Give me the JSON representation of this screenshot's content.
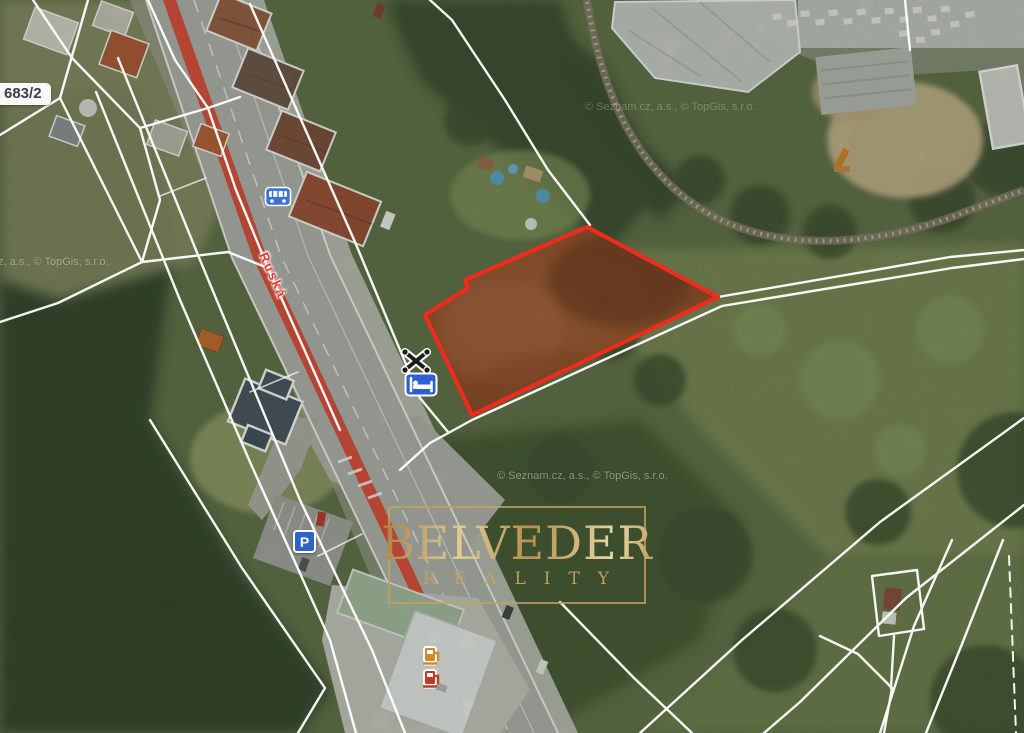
{
  "map": {
    "type": "aerial-cadastral",
    "copyright": "© Seznam.cz, a.s., © TopGis, s.r.o.",
    "parcel_label": "683/2",
    "street_name": "Ruská",
    "watermark": {
      "title": "BELVEDER",
      "subtitle": "REALITY",
      "accent_color": "#c7a260"
    },
    "subject_parcel": {
      "outline_color": "#ee2b1c",
      "fill_color": "#a55c31",
      "status": "highlighted"
    },
    "road_accent_color": "#e14a38",
    "cadastral_line_color": "#ffffff",
    "poi_icons": [
      {
        "name": "bus-stop-icon",
        "meaning": "public transport stop",
        "color": "#3b72d6"
      },
      {
        "name": "restaurant-icon",
        "meaning": "restaurant (crossed cutlery)",
        "color": "#1d1d1b"
      },
      {
        "name": "hotel-icon",
        "meaning": "accommodation (bed)",
        "color": "#2d5fd3"
      },
      {
        "name": "parking-icon",
        "meaning": "parking",
        "color": "#2d62c9",
        "letter": "P"
      },
      {
        "name": "fuel-icon-amber",
        "meaning": "fuel station",
        "color": "#d08a2e"
      },
      {
        "name": "fuel-icon-red",
        "meaning": "fuel station",
        "color": "#c13a27"
      }
    ]
  }
}
